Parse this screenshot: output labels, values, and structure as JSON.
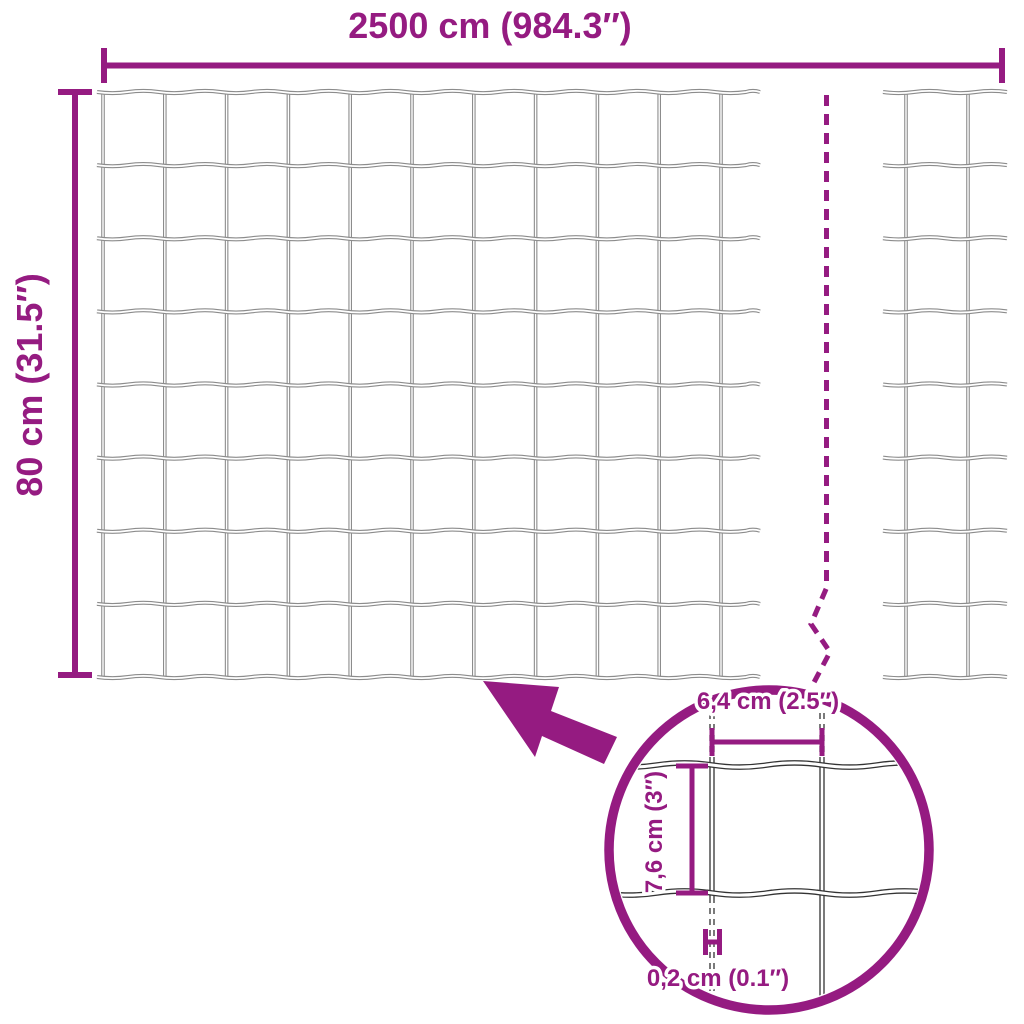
{
  "colors": {
    "accent": "#951b81",
    "wire": "#8c8c8c",
    "wire_detail": "#333333",
    "background": "#ffffff"
  },
  "labels": {
    "total_width": "2500 cm (984.3″)",
    "total_height": "80 cm (31.5″)",
    "mesh_width": "6,4 cm (2.5″)",
    "mesh_height": "7,6 cm (3″)",
    "wire_thickness": "0,2 cm (0.1″)"
  },
  "values": {
    "total_width_cm": 2500,
    "total_width_in": 984.3,
    "total_height_cm": 80,
    "total_height_in": 31.5,
    "mesh_width_cm": 6.4,
    "mesh_width_in": 2.5,
    "mesh_height_cm": 7.6,
    "mesh_height_in": 3,
    "wire_thickness_cm": 0.2,
    "wire_thickness_in": 0.1
  },
  "mesh": {
    "main_section": {
      "vertical_wires": 11,
      "horizontal_wires": 9
    },
    "right_section": {
      "vertical_wires": 2,
      "horizontal_wires": 9
    },
    "detail_section": {
      "vertical_wires": 2,
      "horizontal_wires": 2
    }
  },
  "icons": {
    "arrow": "zoom-callout-arrow",
    "break_line": "continuation-break-line",
    "zoom_circle": "magnifier-detail-circle",
    "gauge_marker": "wire-gauge-marker"
  }
}
